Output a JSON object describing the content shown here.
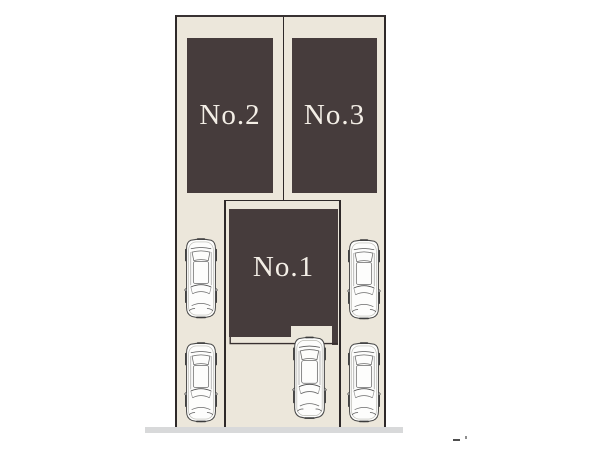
{
  "page": {
    "background": "#ffffff"
  },
  "site_plan": {
    "plots": [
      {
        "label": "No.1"
      },
      {
        "label": "No.2"
      },
      {
        "label": "No.3"
      }
    ],
    "parked_car_count": 5,
    "colors": {
      "ground": "#ece7db",
      "building": "#463c3c",
      "outline": "#2e2929",
      "plot_label_text": "#f3eee6",
      "road": "#d8d9da"
    }
  },
  "icons": {
    "car": "car-top-view-icon"
  },
  "artifacts": {
    "dash_mark": "-",
    "dot_mark": "."
  }
}
